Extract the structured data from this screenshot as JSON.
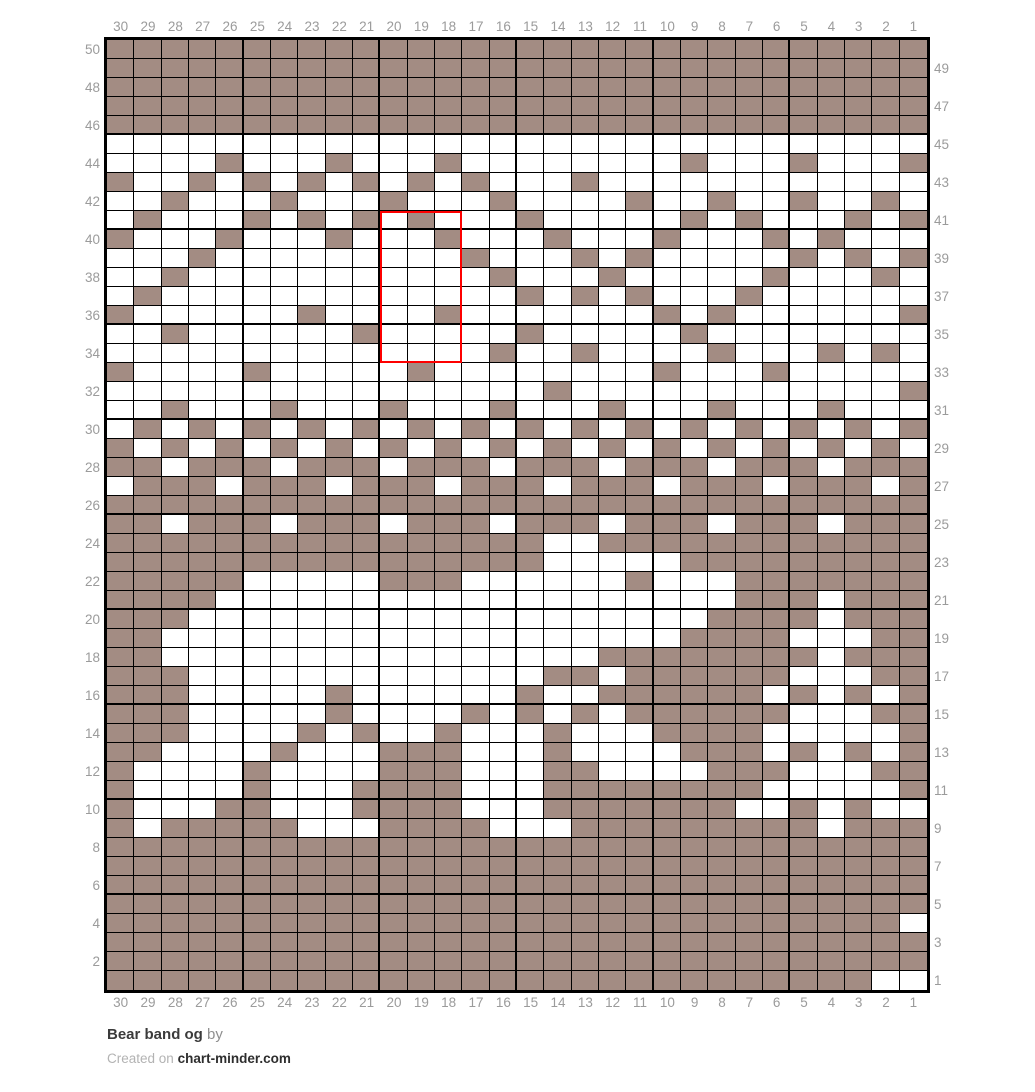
{
  "title": {
    "name": "Bear band og",
    "by_label": "by"
  },
  "credit": {
    "prefix": "Created on",
    "site": "chart-minder.com"
  },
  "colors": {
    "main_color": "#a38c83",
    "background_color": "#ffffff",
    "grid_line": "#000000",
    "selection_red": "#fe0000",
    "axis_label_gray": "#9b9b9b"
  },
  "axes": {
    "top": [
      "30",
      "29",
      "28",
      "27",
      "26",
      "25",
      "24",
      "23",
      "22",
      "21",
      "20",
      "19",
      "18",
      "17",
      "16",
      "15",
      "14",
      "13",
      "12",
      "11",
      "10",
      "9",
      "8",
      "7",
      "6",
      "5",
      "4",
      "3",
      "2",
      "1"
    ],
    "bottom": [
      "30",
      "29",
      "28",
      "27",
      "26",
      "25",
      "24",
      "23",
      "22",
      "21",
      "20",
      "19",
      "18",
      "17",
      "16",
      "15",
      "14",
      "13",
      "12",
      "11",
      "10",
      "9",
      "8",
      "7",
      "6",
      "5",
      "4",
      "3",
      "2",
      "1"
    ],
    "left": [
      "50",
      "48",
      "46",
      "44",
      "42",
      "40",
      "38",
      "36",
      "34",
      "32",
      "30",
      "28",
      "26",
      "24",
      "22",
      "20",
      "18",
      "16",
      "14",
      "12",
      "10",
      "8",
      "6",
      "4",
      "2"
    ],
    "right": [
      "49",
      "47",
      "45",
      "43",
      "41",
      "39",
      "37",
      "35",
      "33",
      "31",
      "29",
      "27",
      "25",
      "23",
      "21",
      "19",
      "17",
      "15",
      "13",
      "11",
      "9",
      "7",
      "5",
      "3",
      "1"
    ]
  },
  "selection": {
    "start_col": 20,
    "end_col": 18,
    "start_row": 41,
    "end_row": 34
  },
  "chart_data": {
    "type": "heatmap",
    "title": "Bear band og",
    "columns": 30,
    "rows": 50,
    "cell_legend": {
      "1": "main color stitch (taupe)",
      "0": "background stitch (white)"
    },
    "bold_grid_every": 5,
    "row_numbers_top_to_bottom": [
      50,
      49,
      48,
      47,
      46,
      45,
      44,
      43,
      42,
      41,
      40,
      39,
      38,
      37,
      36,
      35,
      34,
      33,
      32,
      31,
      30,
      29,
      28,
      27,
      26,
      25,
      24,
      23,
      22,
      21,
      20,
      19,
      18,
      17,
      16,
      15,
      14,
      13,
      12,
      11,
      10,
      9,
      8,
      7,
      6,
      5,
      4,
      3,
      2,
      1
    ],
    "column_numbers_left_to_right": [
      30,
      29,
      28,
      27,
      26,
      25,
      24,
      23,
      22,
      21,
      20,
      19,
      18,
      17,
      16,
      15,
      14,
      13,
      12,
      11,
      10,
      9,
      8,
      7,
      6,
      5,
      4,
      3,
      2,
      1
    ],
    "pattern": [
      "111111111111111111111111111111",
      "111111111111111111111111111111",
      "111111111111111111111111111111",
      "111111111111111111111111111111",
      "111111111111111111111111111111",
      "000000000000000000000000000000",
      "000010001000100000000100010001",
      "100101010101010001000000000000",
      "001000100010001000010010010010",
      "010001010101000100000101000101",
      "100010001000100010001000101000",
      "000100000000010001010000010101",
      "001000000000001000100000100010",
      "010000000000000101010001000000",
      "100000010000100000001010000001",
      "001000000100000100000100000000",
      "000000000000001001000010001010",
      "100001000001000000001000100000",
      "000000000000000010000000000001",
      "001000100010001000100010001000",
      "010101010101010101010101010101",
      "101010101010101010101010101010",
      "110111011101110111011101110111",
      "011101110111011101110111011101",
      "111111111111111111111111111111",
      "110111011101110111011101110111",
      "111111111111111100111111111111",
      "111111111111111100000111111111",
      "111110000011100000010001111111",
      "111100000000000000000001110111",
      "111000000000000000000011110111",
      "110000000000000000000111100011",
      "110000000000000000111111110111",
      "111000000000000011011111100011",
      "111000001000000100111111010101",
      "111000001000010101011111100011",
      "111000010100100010001111000001",
      "110000100011100010000111010101",
      "100001000011100011000011100011",
      "100001000111100011111111000001",
      "100011000111100011111110010100",
      "101111100011110001111111110111",
      "111111111111111111111111111111",
      "111111111111111111111111111111",
      "111111111111111111111111111111",
      "111111111111111111111111111111",
      "111111111111111111111111111110",
      "111111111111111111111111111111",
      "111111111111111111111111111111",
      "111111111111111111111111111100"
    ]
  }
}
